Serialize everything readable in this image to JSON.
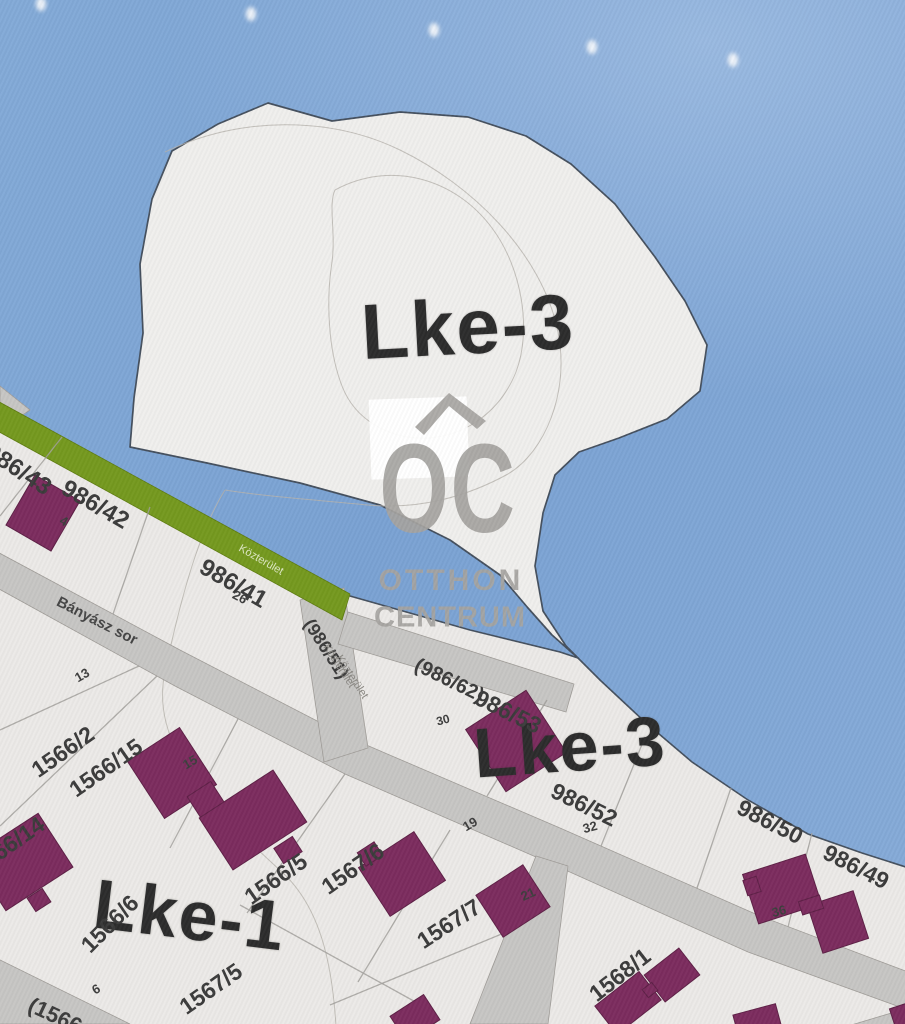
{
  "zones": {
    "lke3_top": "Lke-3",
    "lke3_lower": "Lke-3",
    "lke1": "Lke-1"
  },
  "parcels": {
    "p986_43": "986/43",
    "p986_42": "986/42",
    "p986_41": "986/41",
    "p986_51": "(986/51)",
    "p986_62": "(986/62)",
    "p986_53": "986/53",
    "p986_52": "986/52",
    "p986_50": "986/50",
    "p986_49": "986/49",
    "p1566_2": "1566/2",
    "p1566_15": "1566/15",
    "p1566_14": "1566/14",
    "p1566_5": "1566/5",
    "p1566_6": "1566/6",
    "p1567_6": "1567/6",
    "p1567_7": "1567/7",
    "p1567_5": "1567/5",
    "p1568_1": "1568/1",
    "p1566_partial": "(1566"
  },
  "streets": {
    "banyasz": "Bányász sor",
    "kozterulet_green": "Közterület",
    "kozterulet_a": "Közterület",
    "kozterulet_b": "Közterület"
  },
  "houses": {
    "h4": "4",
    "h26": "26",
    "h13": "13",
    "h30": "30",
    "h19": "19",
    "h15": "15",
    "h32": "32",
    "h21": "21",
    "h36": "36",
    "h6": "6"
  },
  "watermark": {
    "oc": "OC",
    "line1": "OTTHON",
    "line2": "CENTRUM"
  },
  "colors": {
    "sky": "#7fa6d6",
    "zone_fill": "#eceae7",
    "blob_fill": "#f0efed",
    "boundary": "#45505e",
    "road": "#c7c6c4",
    "green_strip": "#75991f",
    "building": "#7c2c5e",
    "parcel_line": "#a3a19e",
    "label": "#3b3b3b",
    "zone_label": "#2c2c2c",
    "watermark": "#a6a4a1"
  }
}
